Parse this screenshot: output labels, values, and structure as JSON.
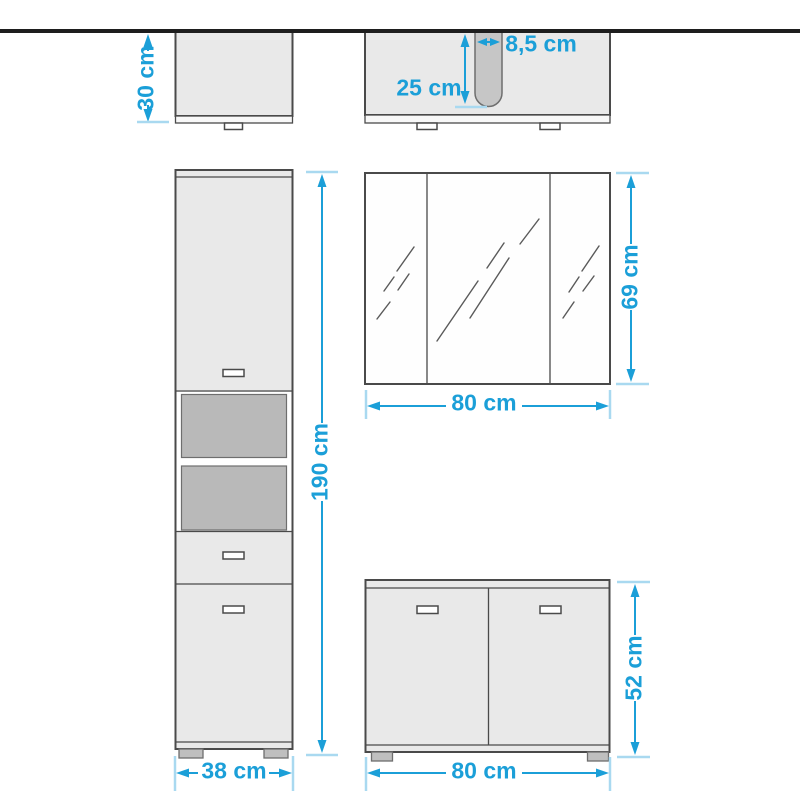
{
  "dimensions": {
    "wall_cabinet_height": "30 cm",
    "washbasin_cutout_depth": "25 cm",
    "washbasin_cutout_width": "8,5 cm",
    "tall_cabinet_height": "190 cm",
    "tall_cabinet_width": "38 cm",
    "mirror_cabinet_width": "80 cm",
    "mirror_cabinet_height": "69 cm",
    "base_cabinet_height": "52 cm",
    "base_cabinet_width": "80 cm"
  },
  "colors": {
    "dimension_blue": "#1b9fd8",
    "extension_blue": "#a9d9f0",
    "outline_dark": "#4a4a4a",
    "line_mid": "#6e6e6e",
    "cabinet_fill": "#e9e9e9",
    "strip_fill": "#f8f8f8",
    "shelf_fill": "#b9b9b9",
    "cutout_fill": "#c6c6c6",
    "foot_fill": "#bfbfbf",
    "wall_black": "#1e1e1e",
    "mirror_fill": "#fefefe",
    "slash_gray": "#5a5a5a"
  }
}
